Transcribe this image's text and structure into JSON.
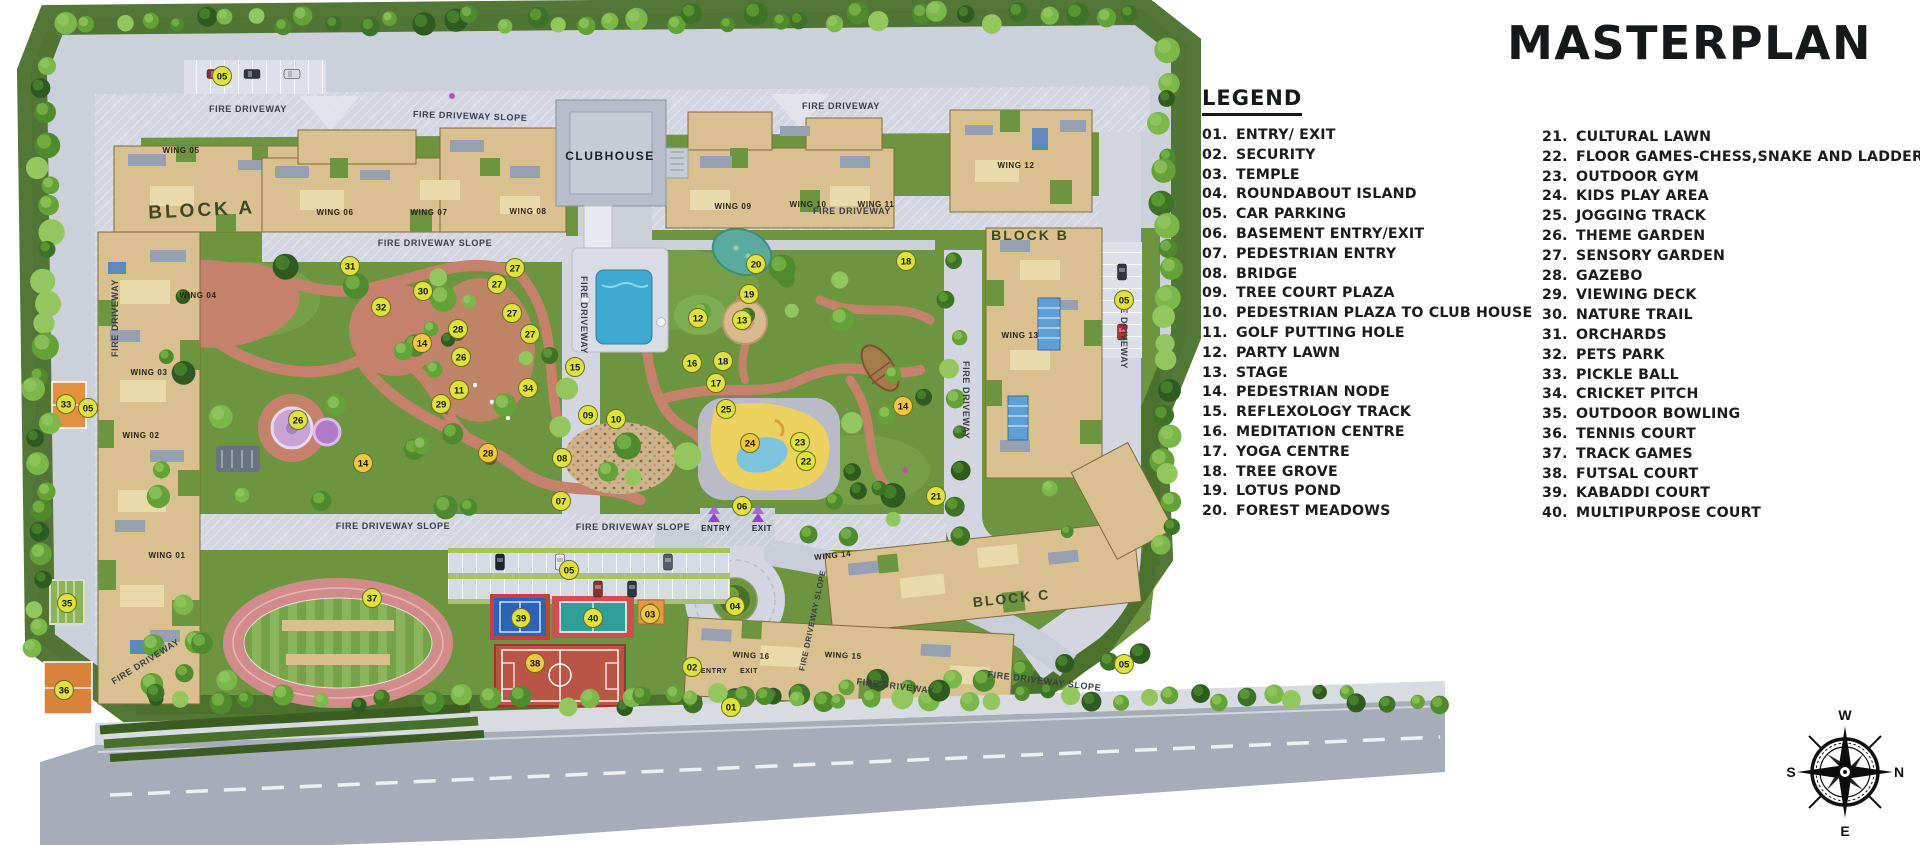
{
  "title": "MASTERPLAN",
  "legend": {
    "heading": "LEGEND",
    "column1": [
      {
        "num": "01.",
        "label": "ENTRY/ EXIT"
      },
      {
        "num": "02.",
        "label": "SECURITY"
      },
      {
        "num": "03.",
        "label": "TEMPLE"
      },
      {
        "num": "04.",
        "label": "ROUNDABOUT ISLAND"
      },
      {
        "num": "05.",
        "label": "CAR PARKING"
      },
      {
        "num": "06.",
        "label": "BASEMENT ENTRY/EXIT"
      },
      {
        "num": "07.",
        "label": "PEDESTRIAN ENTRY"
      },
      {
        "num": "08.",
        "label": "BRIDGE"
      },
      {
        "num": "09.",
        "label": "TREE COURT PLAZA"
      },
      {
        "num": "10.",
        "label": "PEDESTRIAN PLAZA TO CLUB HOUSE"
      },
      {
        "num": "11.",
        "label": "GOLF PUTTING HOLE"
      },
      {
        "num": "12.",
        "label": "PARTY LAWN"
      },
      {
        "num": "13.",
        "label": "STAGE"
      },
      {
        "num": "14.",
        "label": "PEDESTRIAN NODE"
      },
      {
        "num": "15.",
        "label": "REFLEXOLOGY TRACK"
      },
      {
        "num": "16.",
        "label": "MEDITATION CENTRE"
      },
      {
        "num": "17.",
        "label": "YOGA CENTRE"
      },
      {
        "num": "18.",
        "label": "TREE GROVE"
      },
      {
        "num": "19.",
        "label": "LOTUS POND"
      },
      {
        "num": "20.",
        "label": "FOREST MEADOWS"
      }
    ],
    "column2": [
      {
        "num": "21.",
        "label": "CULTURAL LAWN"
      },
      {
        "num": "22.",
        "label": "FLOOR GAMES-CHESS,SNAKE AND LADDER"
      },
      {
        "num": "23.",
        "label": "OUTDOOR GYM"
      },
      {
        "num": "24.",
        "label": "KIDS PLAY AREA"
      },
      {
        "num": "25.",
        "label": "JOGGING TRACK"
      },
      {
        "num": "26.",
        "label": "THEME GARDEN"
      },
      {
        "num": "27.",
        "label": "SENSORY GARDEN"
      },
      {
        "num": "28.",
        "label": "GAZEBO"
      },
      {
        "num": "29.",
        "label": "VIEWING DECK"
      },
      {
        "num": "30.",
        "label": "NATURE TRAIL"
      },
      {
        "num": "31.",
        "label": "ORCHARDS"
      },
      {
        "num": "32.",
        "label": "PETS PARK"
      },
      {
        "num": "33.",
        "label": "PICKLE BALL"
      },
      {
        "num": "34.",
        "label": "CRICKET PITCH"
      },
      {
        "num": "35.",
        "label": "OUTDOOR BOWLING"
      },
      {
        "num": "36.",
        "label": "TENNIS COURT"
      },
      {
        "num": "37.",
        "label": "TRACK GAMES"
      },
      {
        "num": "38.",
        "label": "FUTSAL COURT"
      },
      {
        "num": "39.",
        "label": "KABADDI COURT"
      },
      {
        "num": "40.",
        "label": "MULTIPURPOSE COURT"
      }
    ]
  },
  "plan": {
    "marker_colors": {
      "lime": "#dde23c",
      "gold": "#f2c63e",
      "border": "#6e6e1e",
      "text": "#15150f"
    },
    "labels": [
      {
        "t": "BLOCK A",
        "x": 202,
        "y": 216,
        "s": 19,
        "r": -3,
        "c": "#3c4a20",
        "ls": 3
      },
      {
        "t": "BLOCK B",
        "x": 1030,
        "y": 240,
        "s": 14,
        "c": "#3c4a20",
        "ls": 2
      },
      {
        "t": "BLOCK C",
        "x": 1012,
        "y": 603,
        "s": 14,
        "r": -6,
        "c": "#3c4a20",
        "ls": 2
      },
      {
        "t": "CLUBHOUSE",
        "x": 610,
        "y": 160,
        "s": 12,
        "c": "#1d1f24",
        "ls": 1.5
      },
      {
        "t": "WING 05",
        "x": 181,
        "y": 153,
        "s": 8,
        "c": "#2a2314"
      },
      {
        "t": "WING 04",
        "x": 198,
        "y": 298,
        "s": 8,
        "c": "#2a2314"
      },
      {
        "t": "WING 03",
        "x": 149,
        "y": 375,
        "s": 8,
        "c": "#2a2314"
      },
      {
        "t": "WING 02",
        "x": 141,
        "y": 438,
        "s": 8,
        "c": "#2a2314"
      },
      {
        "t": "WING 01",
        "x": 167,
        "y": 558,
        "s": 8,
        "c": "#2a2314"
      },
      {
        "t": "WING 06",
        "x": 335,
        "y": 215,
        "s": 8,
        "c": "#2a2314"
      },
      {
        "t": "WING 07",
        "x": 429,
        "y": 215,
        "s": 8,
        "c": "#2a2314"
      },
      {
        "t": "WING 08",
        "x": 528,
        "y": 214,
        "s": 8,
        "c": "#2a2314"
      },
      {
        "t": "WING 09",
        "x": 733,
        "y": 209,
        "s": 8,
        "c": "#2a2314"
      },
      {
        "t": "WING 10",
        "x": 808,
        "y": 207,
        "s": 8,
        "c": "#2a2314"
      },
      {
        "t": "WING 11",
        "x": 876,
        "y": 207,
        "s": 8,
        "c": "#2a2314"
      },
      {
        "t": "WING 12",
        "x": 1016,
        "y": 168,
        "s": 8,
        "c": "#2a2314"
      },
      {
        "t": "WING 13",
        "x": 1020,
        "y": 338,
        "s": 8,
        "c": "#2a2314"
      },
      {
        "t": "WING 14",
        "x": 833,
        "y": 558,
        "s": 8,
        "r": -6,
        "c": "#2a2314"
      },
      {
        "t": "WING 15",
        "x": 843,
        "y": 658,
        "s": 8,
        "r": 3,
        "c": "#2a2314"
      },
      {
        "t": "WING 16",
        "x": 751,
        "y": 658,
        "s": 8,
        "r": 3,
        "c": "#2a2314"
      },
      {
        "t": "FIRE DRIVEWAY",
        "x": 248,
        "y": 112,
        "s": 9
      },
      {
        "t": "FIRE DRIVEWAY SLOPE",
        "x": 470,
        "y": 119,
        "s": 9,
        "r": 2
      },
      {
        "t": "FIRE DRIVEWAY",
        "x": 841,
        "y": 109,
        "s": 9
      },
      {
        "t": "FIRE DRIVEWAY SLOPE",
        "x": 435,
        "y": 246,
        "s": 9
      },
      {
        "t": "FIRE DRIVEWAY",
        "x": 852,
        "y": 214,
        "s": 9
      },
      {
        "t": "FIRE DRIVEWAY",
        "x": 118,
        "y": 318,
        "s": 9,
        "r": -90
      },
      {
        "t": "FIRE DRIVEWAY",
        "x": 1121,
        "y": 330,
        "s": 9,
        "r": 90
      },
      {
        "t": "FIRE DRIVEWAY",
        "x": 581,
        "y": 315,
        "s": 9,
        "r": 90
      },
      {
        "t": "FIRE DRIVEWAY",
        "x": 963,
        "y": 400,
        "s": 9,
        "r": 90
      },
      {
        "t": "FIRE DRIVEWAY SLOPE",
        "x": 393,
        "y": 529,
        "s": 9
      },
      {
        "t": "FIRE DRIVEWAY SLOPE",
        "x": 633,
        "y": 530,
        "s": 9
      },
      {
        "t": "FIRE DRIVEWAY",
        "x": 147,
        "y": 664,
        "s": 9,
        "r": -32
      },
      {
        "t": "FIRE DRIVEWAY SLOPE",
        "x": 815,
        "y": 621,
        "s": 8,
        "r": -78
      },
      {
        "t": "FIRE DRIVEWAY",
        "x": 895,
        "y": 689,
        "s": 9,
        "r": 7
      },
      {
        "t": "FIRE DRIVEWAY SLOPE",
        "x": 1044,
        "y": 684,
        "s": 9,
        "r": 7
      },
      {
        "t": "ENTRY",
        "x": 716,
        "y": 531,
        "s": 8,
        "c": "#24262b"
      },
      {
        "t": "EXIT",
        "x": 762,
        "y": 531,
        "s": 8,
        "c": "#24262b"
      },
      {
        "t": "ENTRY",
        "x": 714,
        "y": 673,
        "s": 7,
        "c": "#24262b"
      },
      {
        "t": "EXIT",
        "x": 749,
        "y": 673,
        "s": 7,
        "c": "#24262b"
      }
    ],
    "markers": [
      {
        "n": "05",
        "x": 222,
        "y": 76
      },
      {
        "n": "05",
        "x": 1124,
        "y": 300
      },
      {
        "n": "05",
        "x": 88,
        "y": 408
      },
      {
        "n": "05",
        "x": 569,
        "y": 570
      },
      {
        "n": "05",
        "x": 1124,
        "y": 664
      },
      {
        "n": "33",
        "x": 66,
        "y": 404
      },
      {
        "n": "35",
        "x": 67,
        "y": 603
      },
      {
        "n": "36",
        "x": 64,
        "y": 690
      },
      {
        "n": "31",
        "x": 350,
        "y": 266
      },
      {
        "n": "30",
        "x": 423,
        "y": 291
      },
      {
        "n": "32",
        "x": 381,
        "y": 307
      },
      {
        "n": "27",
        "x": 515,
        "y": 268
      },
      {
        "n": "27",
        "x": 497,
        "y": 284
      },
      {
        "n": "27",
        "x": 512,
        "y": 313
      },
      {
        "n": "27",
        "x": 530,
        "y": 334
      },
      {
        "n": "28",
        "x": 458,
        "y": 329
      },
      {
        "n": "26",
        "x": 461,
        "y": 357
      },
      {
        "n": "14",
        "x": 422,
        "y": 343,
        "g": 1
      },
      {
        "n": "29",
        "x": 441,
        "y": 404
      },
      {
        "n": "26",
        "x": 298,
        "y": 420
      },
      {
        "n": "14",
        "x": 363,
        "y": 463,
        "g": 1
      },
      {
        "n": "28",
        "x": 488,
        "y": 453,
        "g": 1
      },
      {
        "n": "34",
        "x": 528,
        "y": 388
      },
      {
        "n": "15",
        "x": 575,
        "y": 367
      },
      {
        "n": "11",
        "x": 459,
        "y": 390
      },
      {
        "n": "08",
        "x": 562,
        "y": 458
      },
      {
        "n": "07",
        "x": 561,
        "y": 501
      },
      {
        "n": "09",
        "x": 588,
        "y": 415
      },
      {
        "n": "10",
        "x": 616,
        "y": 419
      },
      {
        "n": "12",
        "x": 698,
        "y": 318
      },
      {
        "n": "13",
        "x": 742,
        "y": 320
      },
      {
        "n": "19",
        "x": 749,
        "y": 294
      },
      {
        "n": "20",
        "x": 756,
        "y": 264
      },
      {
        "n": "16",
        "x": 692,
        "y": 363
      },
      {
        "n": "18",
        "x": 723,
        "y": 361
      },
      {
        "n": "17",
        "x": 716,
        "y": 383
      },
      {
        "n": "18",
        "x": 906,
        "y": 261
      },
      {
        "n": "14",
        "x": 903,
        "y": 406,
        "g": 1
      },
      {
        "n": "25",
        "x": 726,
        "y": 409
      },
      {
        "n": "24",
        "x": 750,
        "y": 443,
        "g": 1
      },
      {
        "n": "23",
        "x": 800,
        "y": 442
      },
      {
        "n": "22",
        "x": 806,
        "y": 461
      },
      {
        "n": "21",
        "x": 936,
        "y": 496
      },
      {
        "n": "06",
        "x": 742,
        "y": 506
      },
      {
        "n": "04",
        "x": 735,
        "y": 606
      },
      {
        "n": "37",
        "x": 372,
        "y": 598
      },
      {
        "n": "39",
        "x": 521,
        "y": 618
      },
      {
        "n": "40",
        "x": 593,
        "y": 618
      },
      {
        "n": "38",
        "x": 535,
        "y": 663,
        "g": 1
      },
      {
        "n": "03",
        "x": 650,
        "y": 614,
        "g": 1
      },
      {
        "n": "02",
        "x": 692,
        "y": 667
      },
      {
        "n": "01",
        "x": 731,
        "y": 707
      }
    ]
  },
  "compass": {
    "top": "W",
    "right": "N",
    "bottom": "E",
    "left": "S"
  },
  "colors": {
    "lawn_green": "#6d9441",
    "belt_green": "#49702c",
    "paving": "#ccd0da",
    "road": "#d3d6e0",
    "terracotta": "#c5826a",
    "building_tan": "#d9c08f",
    "pool_blue": "#3fa9cf",
    "play_yellow": "#ecd060"
  }
}
